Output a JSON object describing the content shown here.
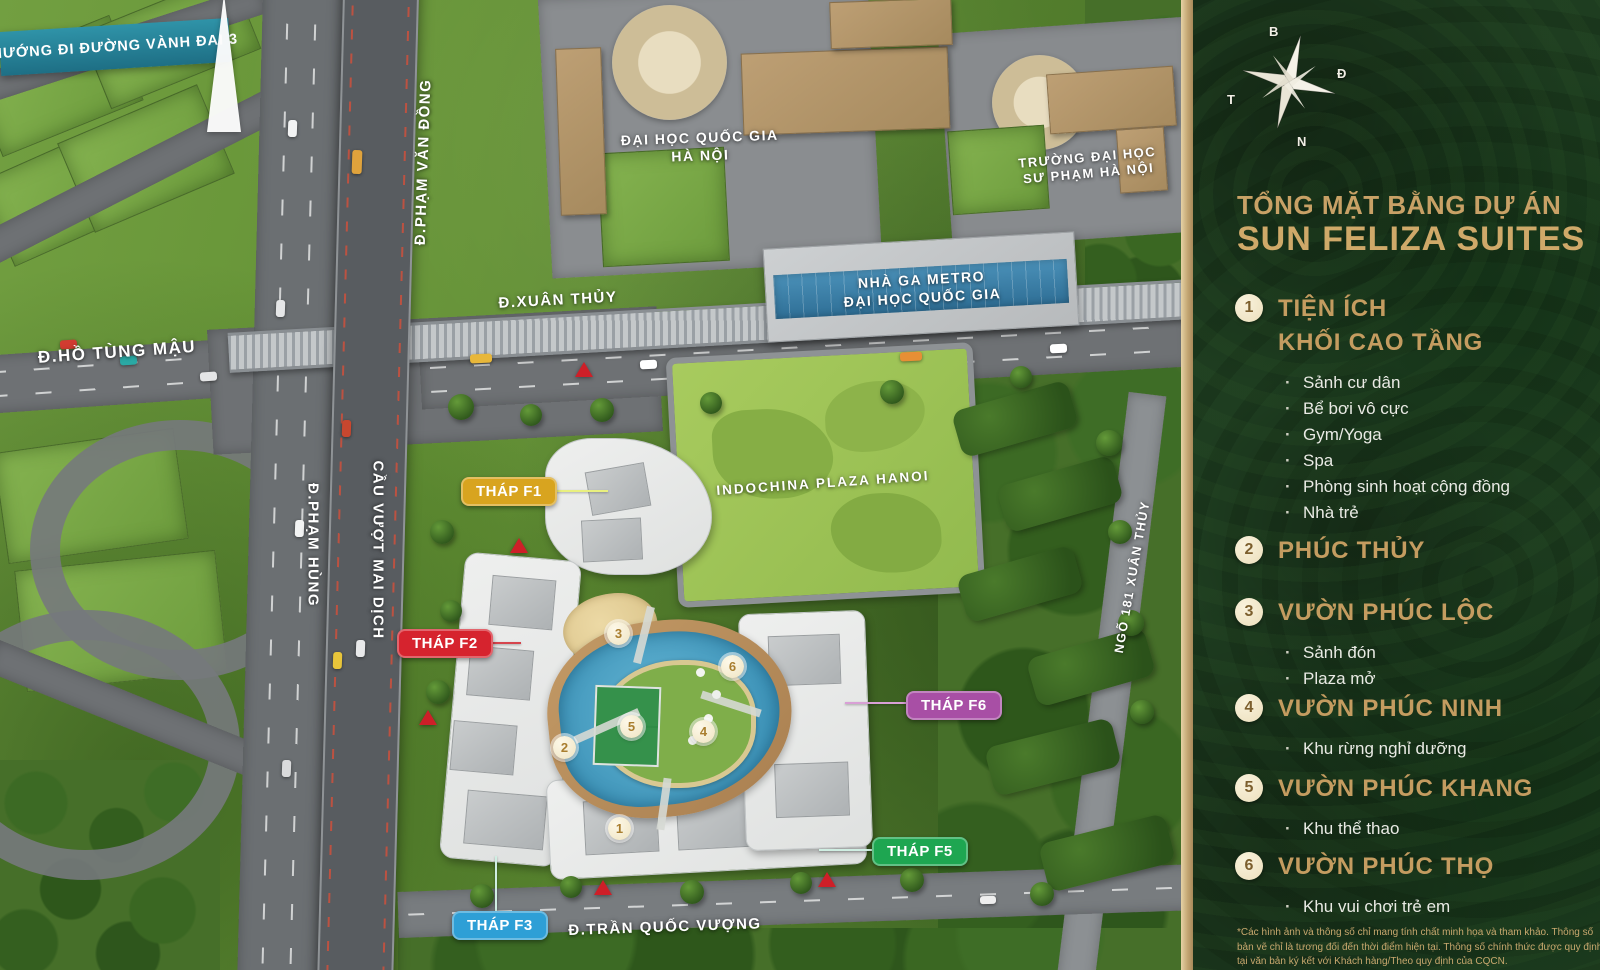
{
  "title": {
    "line1": "TỔNG MẶT BẰNG DỰ ÁN",
    "line2": "SUN FELIZA SUITES"
  },
  "compass": {
    "north": "B",
    "east": "Đ",
    "south": "N",
    "west": "T"
  },
  "map": {
    "banner": "HƯỚNG ĐI ĐƯỜNG VÀNH ĐAI 3",
    "roads": {
      "ho_tung_mau": "Đ.HỒ TÙNG MẬU",
      "xuan_thuy": "Đ.XUÂN THỦY",
      "pham_van_dong": "Đ.PHẠM VĂN ĐỒNG",
      "pham_hung": "Đ.PHẠM HÙNG",
      "cau_vuot_mai_dich": "CẦU VƯỢT MAI DỊCH",
      "ngo_181_xuan_thuy": "NGÕ 181 XUÂN THỦY",
      "tran_quoc_vuong": "Đ.TRẦN QUỐC VƯỢNG"
    },
    "places": {
      "vnu": {
        "line1": "ĐẠI HỌC QUỐC GIA",
        "line2": "HÀ NỘI"
      },
      "hnue": {
        "line1": "TRƯỜNG ĐẠI HỌC",
        "line2": "SƯ PHẠM HÀ NỘI"
      },
      "metro": {
        "line1": "NHÀ GA METRO",
        "line2": "ĐẠI HỌC QUỐC GIA"
      },
      "indochina": "INDOCHINA PLAZA HANOI"
    },
    "towers": [
      {
        "label": "THÁP F1",
        "color": "#d8a41f"
      },
      {
        "label": "THÁP F2",
        "color": "#d6232e"
      },
      {
        "label": "THÁP F3",
        "color": "#2e9fd6"
      },
      {
        "label": "THÁP F5",
        "color": "#1ea651"
      },
      {
        "label": "THÁP F6",
        "color": "#a84fa5"
      }
    ],
    "markers": [
      "1",
      "2",
      "3",
      "4",
      "5",
      "6"
    ]
  },
  "legend": [
    {
      "num": "1",
      "title": "TIỆN ÍCH",
      "title2": "KHỐI CAO TẦNG",
      "items": [
        "Sảnh cư dân",
        "Bể bơi vô cực",
        "Gym/Yoga",
        "Spa",
        "Phòng sinh hoạt cộng đồng",
        "Nhà trẻ"
      ]
    },
    {
      "num": "2",
      "title": "PHÚC THỦY",
      "items": []
    },
    {
      "num": "3",
      "title": "VƯỜN PHÚC LỘC",
      "items": [
        "Sảnh đón",
        "Plaza mở"
      ]
    },
    {
      "num": "4",
      "title": "VƯỜN PHÚC NINH",
      "items": [
        "Khu rừng nghỉ dưỡng"
      ]
    },
    {
      "num": "5",
      "title": "VƯỜN PHÚC KHANG",
      "items": [
        "Khu thể thao"
      ]
    },
    {
      "num": "6",
      "title": "VƯỜN PHÚC THỌ",
      "items": [
        "Khu vui chơi trẻ em"
      ]
    }
  ],
  "disclaimer": "*Các hình ảnh và thông số chỉ mang tính chất minh họa và tham khảo. Thông số bản vẽ chỉ là tương đối đến thời điểm hiện tại. Thông số chính thức được quy định tại văn bản ký kết với Khách hàng/Theo quy định của CQCN.",
  "colors": {
    "sidebar_bg": "#1e3d20",
    "gold_text": "#c8a166",
    "gold_strip": "#c3a673",
    "legend_circle": "#f3ead0",
    "banner_teal": "#2b89a0",
    "marker_number": "#a97e2f",
    "tag_f1": "#d8a41f",
    "tag_f2": "#d6232e",
    "tag_f3": "#2e9fd6",
    "tag_f5": "#1ea651",
    "tag_f6": "#a84fa5",
    "map_green": "#639134",
    "road_gray": "#6e7174",
    "pool_blue": "#4aa3c8"
  }
}
